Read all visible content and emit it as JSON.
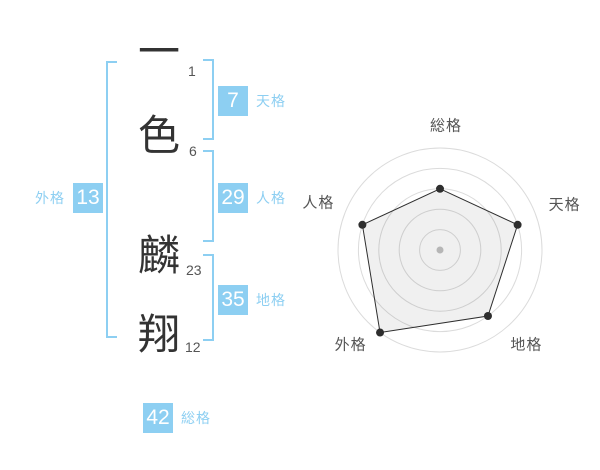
{
  "name": {
    "characters": [
      {
        "char": "一",
        "strokes": "1"
      },
      {
        "char": "色",
        "strokes": "6"
      },
      {
        "char": "麟",
        "strokes": "23"
      },
      {
        "char": "翔",
        "strokes": "12"
      }
    ]
  },
  "kaku": {
    "tenkaku": {
      "label": "天格",
      "value": "7"
    },
    "jinkaku": {
      "label": "人格",
      "value": "29"
    },
    "chikaku": {
      "label": "地格",
      "value": "35"
    },
    "gaikaku": {
      "label": "外格",
      "value": "13"
    },
    "soukaku": {
      "label": "総格",
      "value": "42"
    }
  },
  "colors": {
    "accent_blue": "#8DCFF2",
    "kanji_text": "#333333",
    "stroke_count_text": "#555555",
    "chart_grid": "#DBDBDB",
    "chart_series": "#2E2E2E",
    "chart_fill": "rgba(0,0,0,0.06)",
    "chart_label": "#555555",
    "chart_center_dot": "#C2C2C2"
  },
  "chart_data": {
    "type": "radar",
    "categories": [
      "総格",
      "天格",
      "地格",
      "外格",
      "人格"
    ],
    "values": [
      3,
      4,
      4,
      5,
      4
    ],
    "max": 5,
    "rings": 5,
    "grid": "concentric-circles",
    "legend": "none",
    "spokes": false
  }
}
